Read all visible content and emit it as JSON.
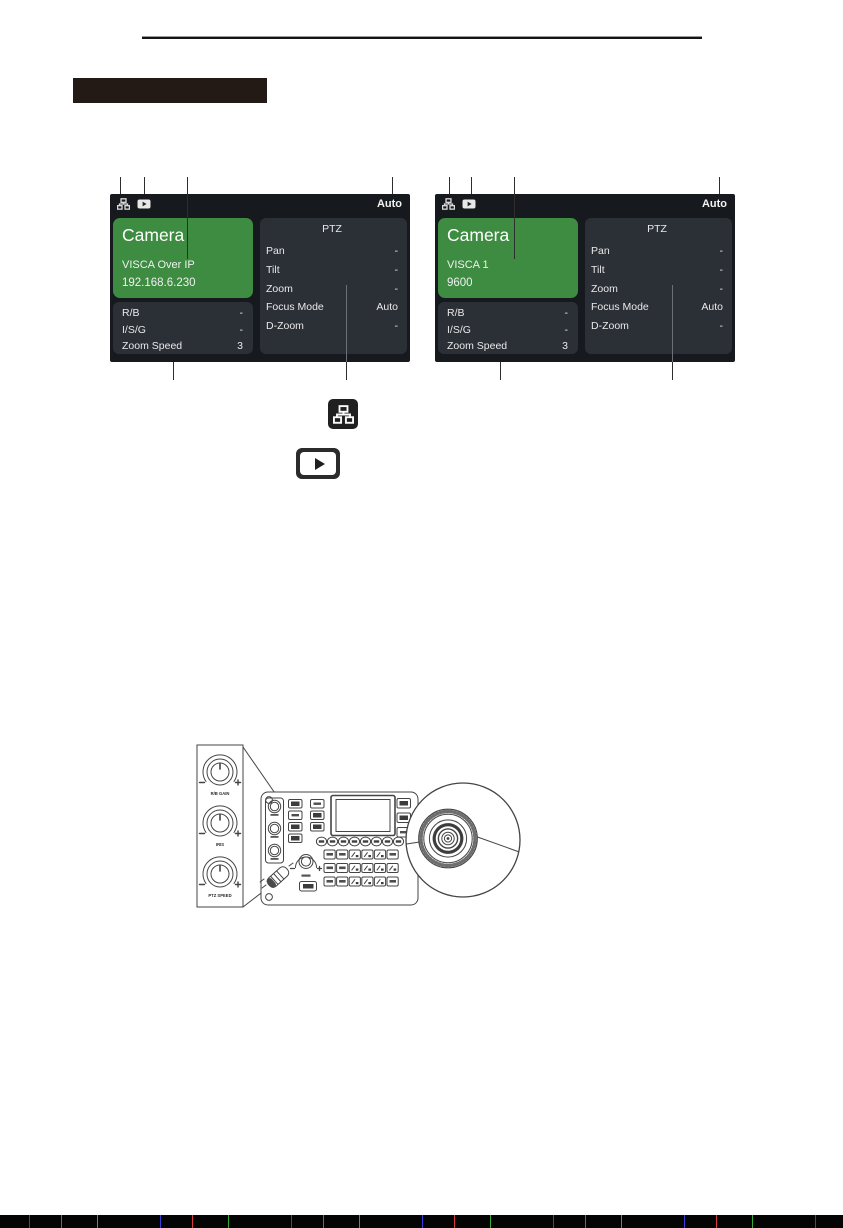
{
  "panels": [
    {
      "status_bar": {
        "mode": "Auto"
      },
      "camera_box": {
        "title": "Camera",
        "protocol": "VISCA Over IP",
        "address": "192.168.6.230"
      },
      "image_box": {
        "rows": [
          {
            "label": "R/B",
            "value": "-"
          },
          {
            "label": "I/S/G",
            "value": "-"
          },
          {
            "label": "Zoom Speed",
            "value": "3"
          }
        ]
      },
      "ptz_box": {
        "title": "PTZ",
        "rows": [
          {
            "label": "Pan",
            "value": "-"
          },
          {
            "label": "Tilt",
            "value": "-"
          },
          {
            "label": "Zoom",
            "value": "-"
          },
          {
            "label": "Focus Mode",
            "value": "Auto"
          },
          {
            "label": "D-Zoom",
            "value": "-"
          }
        ]
      }
    },
    {
      "status_bar": {
        "mode": "Auto"
      },
      "camera_box": {
        "title": "Camera",
        "protocol": "VISCA 1",
        "address": "9600"
      },
      "image_box": {
        "rows": [
          {
            "label": "R/B",
            "value": "-"
          },
          {
            "label": "I/S/G",
            "value": "-"
          },
          {
            "label": "Zoom Speed",
            "value": "3"
          }
        ]
      },
      "ptz_box": {
        "title": "PTZ",
        "rows": [
          {
            "label": "Pan",
            "value": "-"
          },
          {
            "label": "Tilt",
            "value": "-"
          },
          {
            "label": "Zoom",
            "value": "-"
          },
          {
            "label": "Focus Mode",
            "value": "Auto"
          },
          {
            "label": "D-Zoom",
            "value": "-"
          }
        ]
      }
    }
  ],
  "legend_icons": [
    {
      "name": "network-icon"
    },
    {
      "name": "play-icon"
    }
  ],
  "controller": {
    "knobs": [
      {
        "label": "R/B GAIN"
      },
      {
        "label": "IRIS"
      },
      {
        "label": "PTZ SPEED"
      }
    ]
  },
  "colors": {
    "lcd_green": "#3d8c41",
    "lcd_background": "#16191d",
    "lcd_box": "#2b2f36",
    "lcd_text": "#e9e9e9",
    "header_box": "#241a15"
  }
}
